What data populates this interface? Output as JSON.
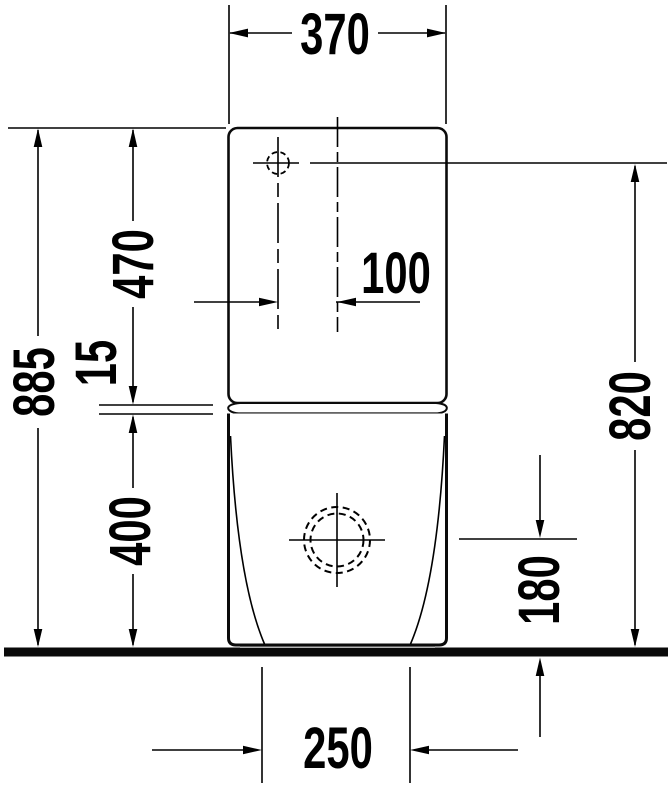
{
  "drawing": {
    "dimensions": {
      "tank_width_top": "370",
      "inlet_offset_from_center": "100",
      "tank_height": "470",
      "seam_gap": "15",
      "total_height": "885",
      "bowl_height": "400",
      "inlet_height_above_floor": "820",
      "outlet_height_above_floor": "180",
      "base_width": "250"
    },
    "colors": {
      "line": "#000000",
      "background": "#ffffff",
      "ground": "#0a0a0a",
      "foot_shadow": "#b5b5b5"
    }
  }
}
